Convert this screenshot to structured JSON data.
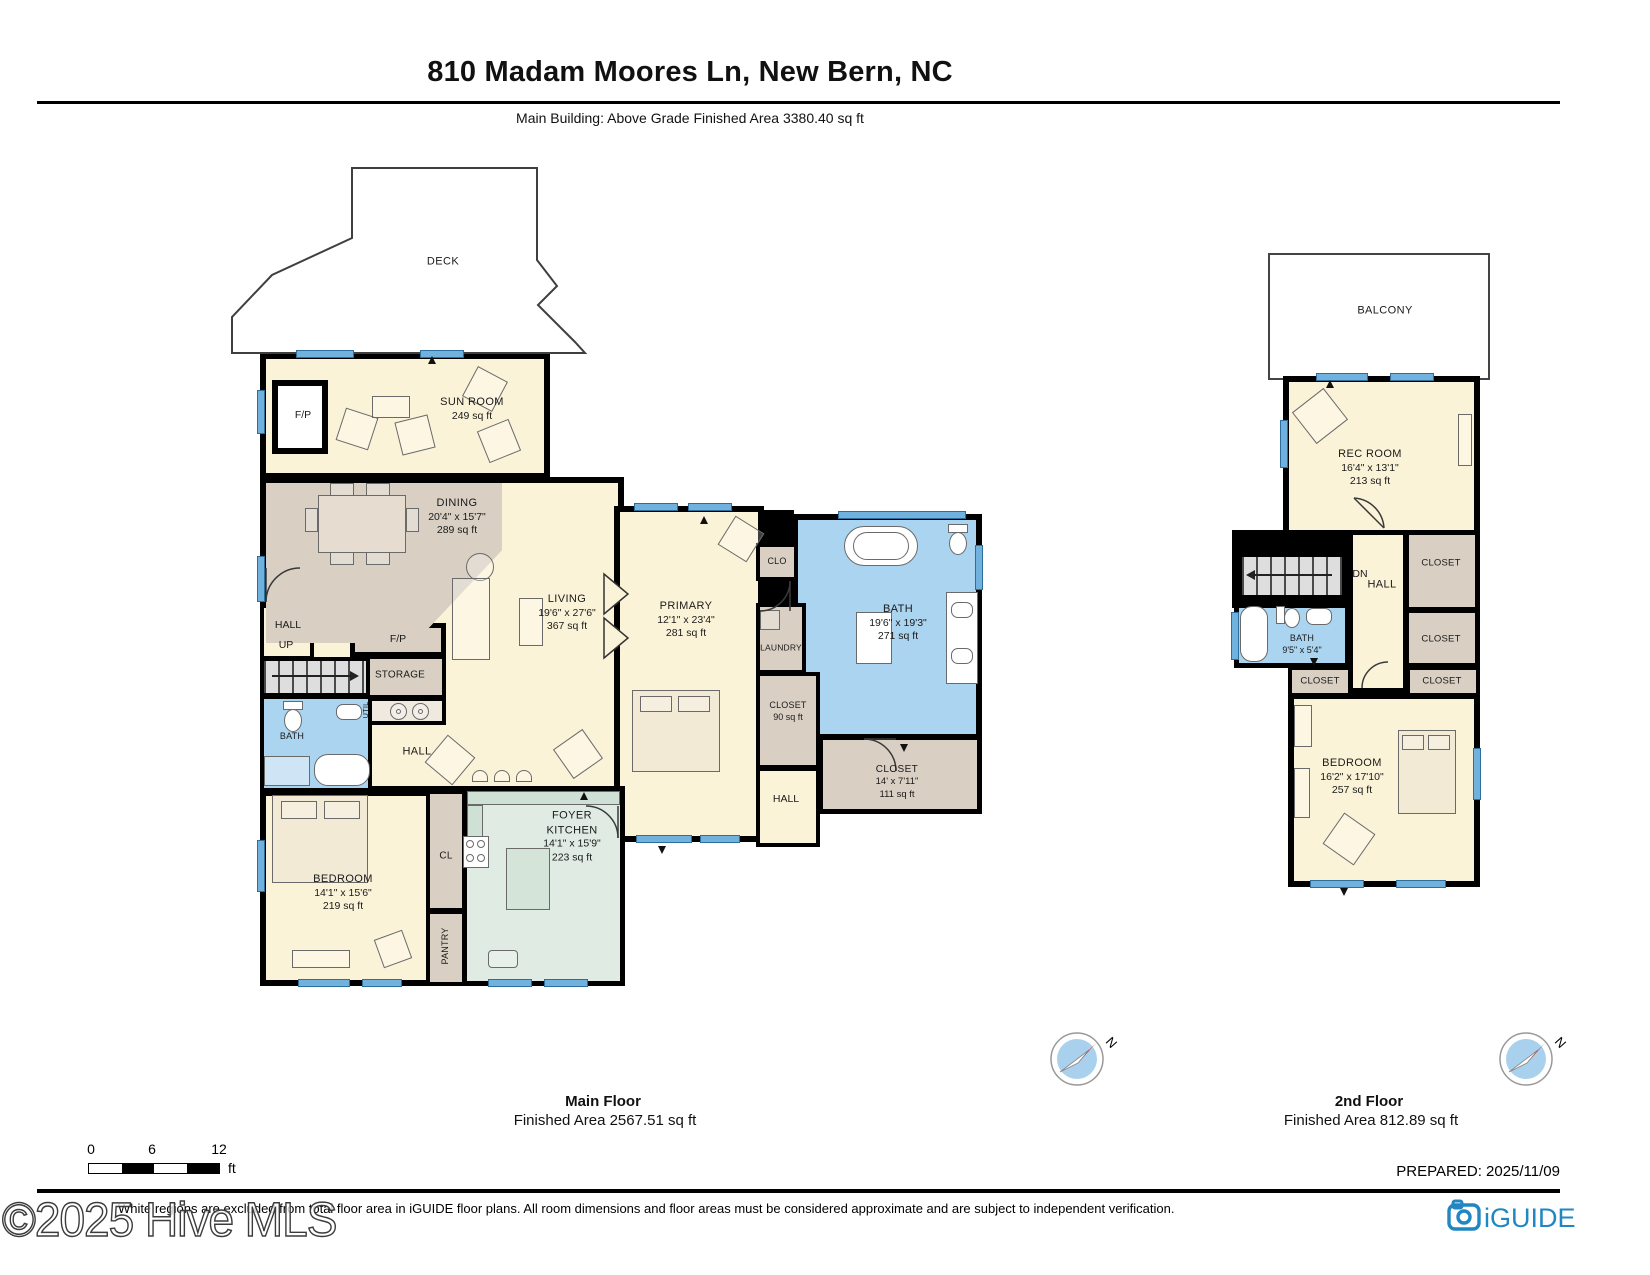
{
  "header": {
    "title": "810 Madam Moores Ln, New Bern, NC",
    "subtitle": "Main Building: Above Grade Finished Area 3380.40 sq ft"
  },
  "floors": {
    "main": {
      "caption": "Main Floor",
      "area_caption": "Finished Area 2567.51 sq ft",
      "rooms": {
        "deck": {
          "name": "DECK"
        },
        "sun_room": {
          "name": "SUN ROOM",
          "area": "249 sq ft"
        },
        "fireplace_sun": {
          "name": "F/P"
        },
        "dining": {
          "name": "DINING",
          "dims": "20'4\" x 15'7\"",
          "area": "289 sq ft"
        },
        "living": {
          "name": "LIVING",
          "dims": "19'6\" x 27'6\"",
          "area": "367 sq ft"
        },
        "fireplace_living": {
          "name": "F/P"
        },
        "hall_stairs": {
          "name": "HALL",
          "up": "UP"
        },
        "storage": {
          "name": "STORAGE"
        },
        "util": {
          "name": "UTIL"
        },
        "bath": {
          "name": "BATH"
        },
        "hall_center": {
          "name": "HALL"
        },
        "bedroom": {
          "name": "BEDROOM",
          "dims": "14'1\" x 15'6\"",
          "area": "219 sq ft"
        },
        "closet_cl": {
          "name": "CL"
        },
        "pantry": {
          "name": "PANTRY"
        },
        "foyer_kitchen": {
          "name1": "FOYER",
          "name2": "KITCHEN",
          "dims": "14'1\" x 15'9\"",
          "area": "223 sq ft"
        },
        "primary": {
          "name": "PRIMARY",
          "dims": "12'1\" x 23'4\"",
          "area": "281 sq ft"
        },
        "clo": {
          "name": "CLO"
        },
        "laundry": {
          "name": "LAUNDRY"
        },
        "primary_bath": {
          "name": "BATH",
          "dims": "19'6\" x 19'3\"",
          "area": "271 sq ft"
        },
        "closet_90": {
          "name": "CLOSET",
          "area": "90 sq ft"
        },
        "closet_111": {
          "name": "CLOSET",
          "dims": "14' x 7'11\"",
          "area": "111 sq ft"
        },
        "hall_bath": {
          "name": "HALL"
        }
      }
    },
    "second": {
      "caption": "2nd Floor",
      "area_caption": "Finished Area 812.89 sq ft",
      "rooms": {
        "balcony": {
          "name": "BALCONY"
        },
        "rec_room": {
          "name": "REC ROOM",
          "dims": "16'4\" x 13'1\"",
          "area": "213 sq ft"
        },
        "dn": {
          "name": "DN"
        },
        "hall": {
          "name": "HALL"
        },
        "closet_top": {
          "name": "CLOSET"
        },
        "closet_mid": {
          "name": "CLOSET"
        },
        "closet_left": {
          "name": "CLOSET"
        },
        "closet_right": {
          "name": "CLOSET"
        },
        "bath": {
          "name": "BATH",
          "dims": "9'5\" x 5'4\""
        },
        "bedroom": {
          "name": "BEDROOM",
          "dims": "16'2\" x 17'10\"",
          "area": "257 sq ft"
        }
      }
    }
  },
  "scale_bar": {
    "tick0": "0",
    "tick1": "6",
    "tick2": "12",
    "unit": "ft"
  },
  "compass": {
    "label": "N"
  },
  "footer": {
    "prepared": "PREPARED: 2025/11/09",
    "disclaimer": "White regions are excluded from total floor area in iGUIDE floor plans. All room dimensions and floor areas must be considered approximate and are subject to independent verification.",
    "watermark": "©2025 Hive MLS",
    "brand": "iGUIDE"
  },
  "colors": {
    "room_cream": "#fbf3d8",
    "room_tan": "#d9d0c3",
    "room_blue": "#abd4f0",
    "room_mint": "#e0ebe3",
    "wall": "#000000",
    "window": "#71b1dd",
    "brand_blue": "#2187c2",
    "compass_red": "#d42020"
  }
}
